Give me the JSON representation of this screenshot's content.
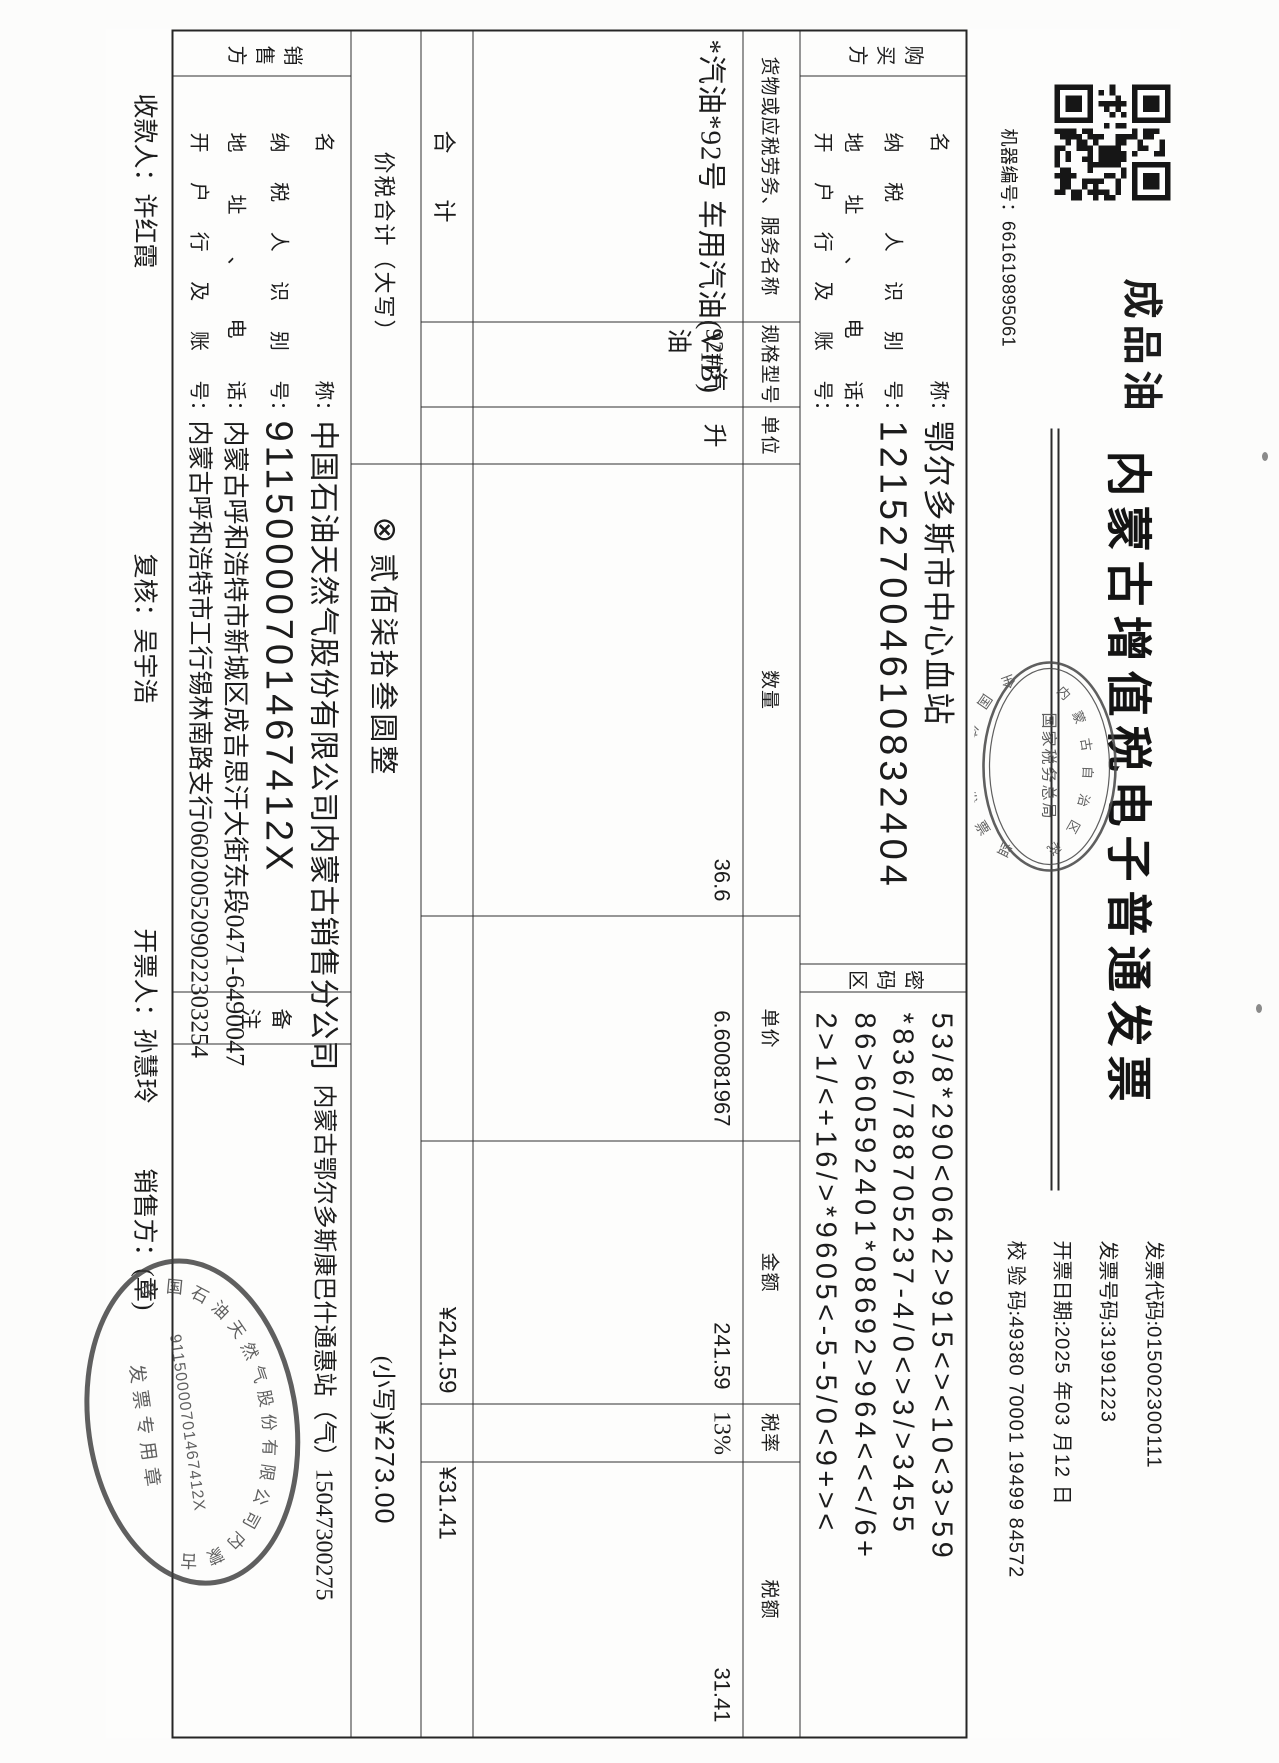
{
  "header": {
    "machine_label": "机器编号：",
    "machine_no": "661619895061",
    "fuel_mark": "成品油",
    "title": "内蒙古增值税电子普通发票",
    "meta": [
      {
        "label": "发票代码:",
        "value": "015002300111"
      },
      {
        "label": "发票号码:",
        "value": "31991223"
      },
      {
        "label": "开票日期:",
        "value": "2025 年03 月12 日"
      },
      {
        "label": "校 验 码:",
        "value": "49380 70001 19499 84572"
      }
    ]
  },
  "colon": "：",
  "buyer": {
    "side_label": "购买方",
    "rows": [
      {
        "label": "名称",
        "value": "鄂尔多斯市中心血站"
      },
      {
        "label": "纳税人识别号",
        "value": "121527004610832404"
      },
      {
        "label": "地址、电话",
        "value": ""
      },
      {
        "label": "开户行及账号",
        "value": ""
      }
    ]
  },
  "password_area": {
    "side_label": "密码区",
    "lines": [
      "53/8*290<0642>915<><10<3>59",
      "*836/788705237-4/0<>3/>3455",
      "86>60592401*08692>964<<</6+",
      "2>1/<+16/>*9605<-5-5/0<9+><"
    ]
  },
  "table": {
    "headers": [
      "货物或应税劳务、服务名称",
      "规格型号",
      "单位",
      "数量",
      "单价",
      "金额",
      "税率",
      "税额"
    ],
    "row": {
      "name": "*汽油*92号 车用汽油(VIB)",
      "spec": "92#汽油",
      "unit": "升",
      "qty": "36.6",
      "price": "6.60081967",
      "amount": "241.59",
      "rate": "13%",
      "tax": "31.41"
    },
    "total_label": "合        计",
    "total_amount": "¥241.59",
    "total_tax": "¥31.41"
  },
  "amount_row": {
    "label": "价税合计（大写）",
    "symbol": "⊗",
    "words": "贰佰柒拾叁圆整",
    "small_label": "(小写)",
    "figures": "¥273.00"
  },
  "seller": {
    "side_label": "销售方",
    "rows": [
      {
        "label": "名称",
        "value": "中国石油天然气股份有限公司内蒙古销售分公司"
      },
      {
        "label": "纳税人识别号",
        "value": "91150000701467412X"
      },
      {
        "label": "地址、电话",
        "value": "内蒙古呼和浩特市新城区成吉思汗大街东段0471-6490047"
      },
      {
        "label": "开户行及账号",
        "value": "内蒙古呼和浩特市工行锡林南路支行0602005209022303254"
      }
    ]
  },
  "remark": {
    "side_label": "备注",
    "content": "内蒙古鄂尔多斯康巴什通惠站（气）15047300275"
  },
  "footer": [
    {
      "label": "收款人：",
      "value": "许红霞"
    },
    {
      "label": "复核：",
      "value": "吴宇浩"
    },
    {
      "label": "开票人：",
      "value": "孙慧玲"
    },
    {
      "label": "销售方：",
      "value": "(章)"
    }
  ],
  "seals": {
    "supervision": {
      "arc_top": "全国统一发票监制章",
      "center": "国家税务总局",
      "arc_bottom": "内蒙古自治区税务局",
      "color": "#4a4a4a"
    },
    "company": {
      "ring": "中国石油天然气股份有限公司内蒙古销售分公司",
      "tax_id": "91150000701467412X",
      "type": "发票专用章",
      "color": "#3d3d3d"
    }
  }
}
